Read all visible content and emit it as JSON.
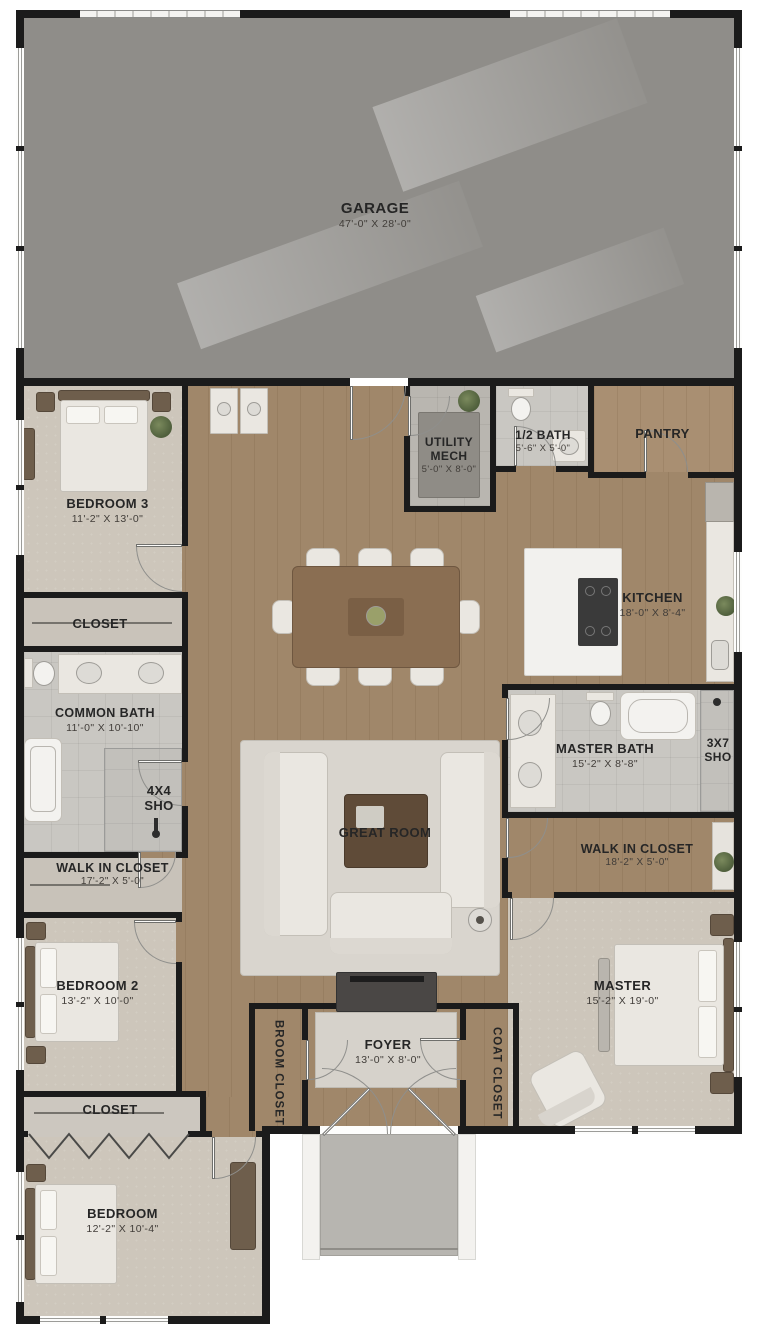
{
  "rooms": {
    "garage": {
      "name": "GARAGE",
      "dims": "47'-0\" X 28'-0\""
    },
    "bedroom3": {
      "name": "BEDROOM 3",
      "dims": "11'-2\" X 13'-0\""
    },
    "closet_left": {
      "name": "CLOSET"
    },
    "common_bath": {
      "name": "COMMON BATH",
      "dims": "11'-0\" X 10'-10\""
    },
    "shower_4x4": {
      "line1": "4X4",
      "line2": "SHO"
    },
    "wic_left": {
      "name": "WALK IN CLOSET",
      "dims": "17'-2\" X 5'-0\""
    },
    "bedroom2": {
      "name": "BEDROOM 2",
      "dims": "13'-2\" X 10'-0\""
    },
    "closet_bottom": {
      "name": "CLOSET"
    },
    "bedroom": {
      "name": "BEDROOM",
      "dims": "12'-2\" X 10'-4\""
    },
    "utility_mech": {
      "line1": "UTILITY",
      "line2": "MECH",
      "dims": "5'-0\" X 8'-0\""
    },
    "half_bath": {
      "name": "1/2 BATH",
      "dims": "5'-6\" X 5'-0\""
    },
    "pantry": {
      "name": "PANTRY"
    },
    "kitchen": {
      "name": "KITCHEN",
      "dims": "18'-0\" X 8'-4\""
    },
    "great_room": {
      "name": "GREAT ROOM"
    },
    "master_bath": {
      "name": "MASTER BATH",
      "dims": "15'-2\" X 8'-8\""
    },
    "shower_3x7": {
      "line1": "3X7",
      "line2": "SHO"
    },
    "wic_right": {
      "name": "WALK IN CLOSET",
      "dims": "18'-2\" X 5'-0\""
    },
    "master": {
      "name": "MASTER",
      "dims": "15'-2\" X 19'-0\""
    },
    "foyer": {
      "name": "FOYER",
      "dims": "13'-0\" X 8'-0\""
    },
    "broom_closet": {
      "name": "BROOM CLOSET"
    },
    "coat_closet": {
      "name": "COAT CLOSET"
    }
  },
  "palette": {
    "wall": "#1b1b1b",
    "wood_floor": "#a0876a",
    "carpet": "#cdc6bb",
    "tile": "#c9c7c2",
    "garage_floor": "#8f8d89",
    "rug": "#d8d4cd",
    "furniture_light": "#eae7e1",
    "label_text": "#262626"
  }
}
